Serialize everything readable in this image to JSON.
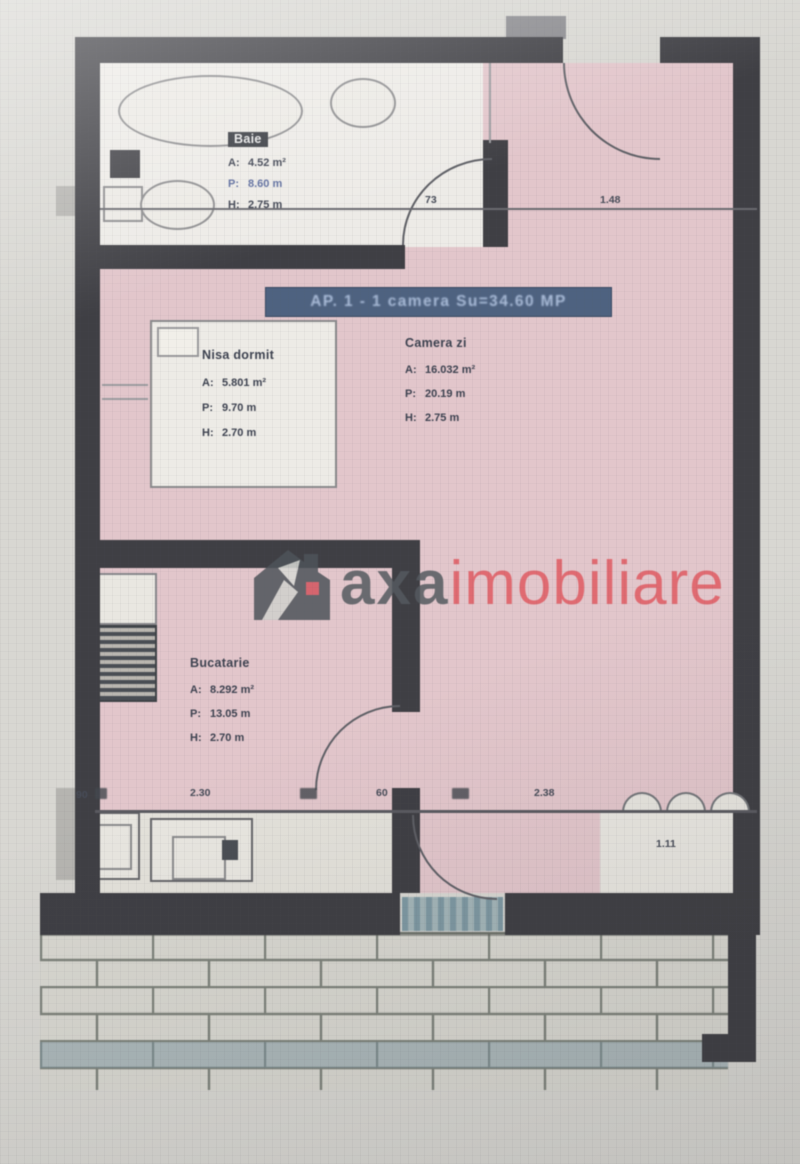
{
  "banner": {
    "text": "AP. 1 - 1 camera Su=34.60 MP"
  },
  "watermark": {
    "brand": "axa",
    "suffix": "imobiliare"
  },
  "rooms": {
    "bathroom": {
      "name": "Baie",
      "a_k": "A:",
      "a_v": "4.52 m²",
      "p_k": "P:",
      "p_v": "8.60 m",
      "h_k": "H:",
      "h_v": "2.75 m"
    },
    "bedroom": {
      "name": "Nisa dormit",
      "a_k": "A:",
      "a_v": "5.801 m²",
      "p_k": "P:",
      "p_v": "9.70 m",
      "h_k": "H:",
      "h_v": "2.70 m"
    },
    "living": {
      "name": "Camera zi",
      "a_k": "A:",
      "a_v": "16.032 m²",
      "p_k": "P:",
      "p_v": "20.19 m",
      "h_k": "H:",
      "h_v": "2.75 m"
    },
    "kitchen": {
      "name": "Bucatarie",
      "a_k": "A:",
      "a_v": "8.292 m²",
      "p_k": "P:",
      "p_v": "13.05 m",
      "h_k": "H:",
      "h_v": "2.70 m"
    }
  },
  "dim_labels": {
    "top_a": "73",
    "top_b": "1.48",
    "bottom_left": "90",
    "bottom_a": "2.30",
    "bottom_b": "60",
    "bottom_c": "2.38",
    "bottom_d": "1.11"
  }
}
